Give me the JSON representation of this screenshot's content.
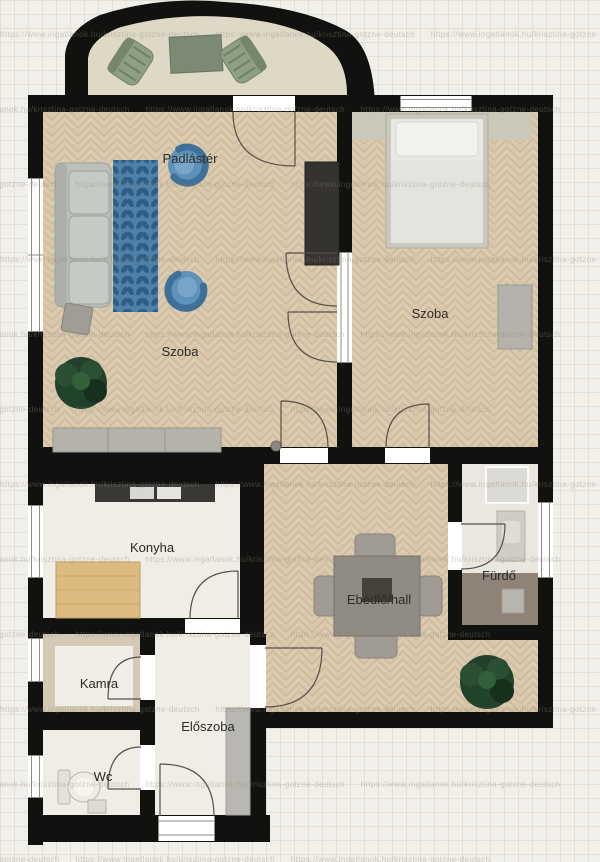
{
  "document": {
    "type": "apartment-floor-plan",
    "language": "hu"
  },
  "watermark": {
    "text": "https://www.ingatlanok.hu/krisztina-gotzne-deutsch"
  },
  "rooms": [
    {
      "id": "attic-balcony",
      "label": "Padlástér"
    },
    {
      "id": "living-room",
      "label": "Szoba"
    },
    {
      "id": "bedroom",
      "label": "Szoba"
    },
    {
      "id": "kitchen",
      "label": "Konyha"
    },
    {
      "id": "dining-hall",
      "label": "Ebédlő/hall"
    },
    {
      "id": "bathroom",
      "label": "Fürdő"
    },
    {
      "id": "pantry",
      "label": "Kamra"
    },
    {
      "id": "entry-hall",
      "label": "Előszoba"
    },
    {
      "id": "wc",
      "label": "Wc"
    }
  ],
  "furniture": [
    "balcony-armchair-left",
    "balcony-table",
    "balcony-armchair-right",
    "sofa",
    "area-rug",
    "armchair-top",
    "armchair-bottom",
    "coffee-table",
    "plant",
    "sideboard",
    "tall-cabinet",
    "headboard-shelf",
    "double-bed",
    "dresser",
    "kitchen-counter",
    "kitchen-table",
    "dining-table",
    "dining-chairs",
    "centerpiece",
    "dining-plant",
    "shower",
    "vanity-sink",
    "washing-machine",
    "toilet",
    "wc-sink",
    "hall-closet"
  ],
  "colors": {
    "bg": "#f1efe9",
    "grid": "#e2e0d6",
    "wall": "#111110",
    "woodBase": "#d8c7ab",
    "woodLine": "#c2ad8d",
    "woodLight": "#e5d7bd",
    "floorLight": "#efede6",
    "floorKamra": "#d3c9b5",
    "kamraInner": "#f1eee8",
    "floorBathTop": "#eae7e0",
    "floorBathBottom": "#8e8376",
    "balconyFloor": "#ded8c7",
    "rugBase": "#4e80a8",
    "rugDark": "#2d5e86",
    "armchair": "#5e92ba",
    "armchairDark": "#3f7099",
    "sofa": "#bcc0ba",
    "sofaDark": "#9da29c",
    "plant": "#22402a",
    "plantDark": "#16301c",
    "bedFrame": "#c9c8bf",
    "bedMattress": "#e9e9e4",
    "headboard": "#cbc8b7",
    "grayFurn": "#b4b2ab",
    "darkFurn": "#35332f",
    "tableGray": "#908c83",
    "chairGray": "#a09c93",
    "wood": "#ddba80",
    "counter": "#3a3835",
    "doorArc": "#55504a",
    "label": "#2b2b26",
    "watermark": "#8a8778",
    "windowFrame": "#8d8d86"
  }
}
